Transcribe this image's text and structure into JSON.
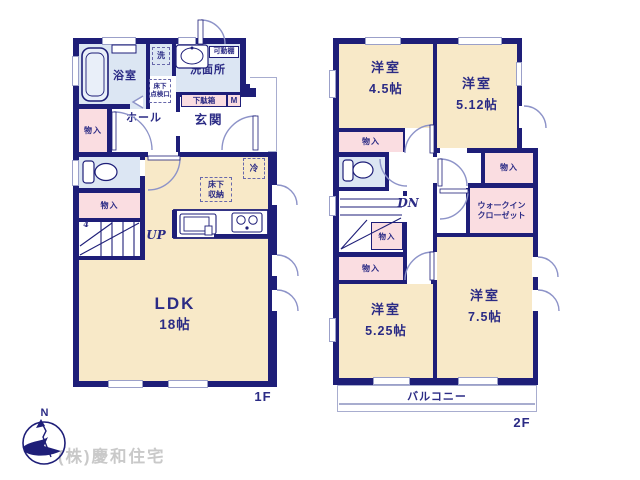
{
  "colors": {
    "wall": "#1e1e78",
    "room_cream": "#f8e9c8",
    "wet_blue": "#dce6f3",
    "closet_pink": "#fadde1",
    "door_arc": "#8d93c8",
    "label_navy": "#2b2b85",
    "watermark_gray": "#c9c9c9"
  },
  "compass": {
    "north_label": "N"
  },
  "watermark": {
    "company": "(株)慶和住宅"
  },
  "floor1": {
    "floor_label": "1F",
    "ldk_name": "LDK",
    "ldk_size": "18帖",
    "bathroom": "浴室",
    "laundry": "洗",
    "washroom": "洗面所",
    "movable_shelf": "可動棚",
    "underfloor_hatch_1": "床下",
    "underfloor_hatch_2": "点検口",
    "shoebox": "下駄箱",
    "meter_box": "M",
    "entrance": "玄関",
    "hall": "ホール",
    "storage_west": "物入",
    "storage_southwest": "物入",
    "stairs_up": "UP",
    "stairs_step_no": "4",
    "fridge": "冷",
    "underfloor_storage_1": "床下",
    "underfloor_storage_2": "収納"
  },
  "floor2": {
    "floor_label": "2F",
    "room_45_name": "洋室",
    "room_45_size": "4.5帖",
    "room_512_name": "洋室",
    "room_512_size": "5.12帖",
    "room_525_name": "洋室",
    "room_525_size": "5.25帖",
    "room_75_name": "洋室",
    "room_75_size": "7.5帖",
    "wic_1": "ウォークイン",
    "wic_2": "クローゼット",
    "storage_a": "物入",
    "storage_b": "物入",
    "storage_c": "物入",
    "storage_d": "物入",
    "stairs_down": "DN",
    "balcony": "バルコニー"
  }
}
